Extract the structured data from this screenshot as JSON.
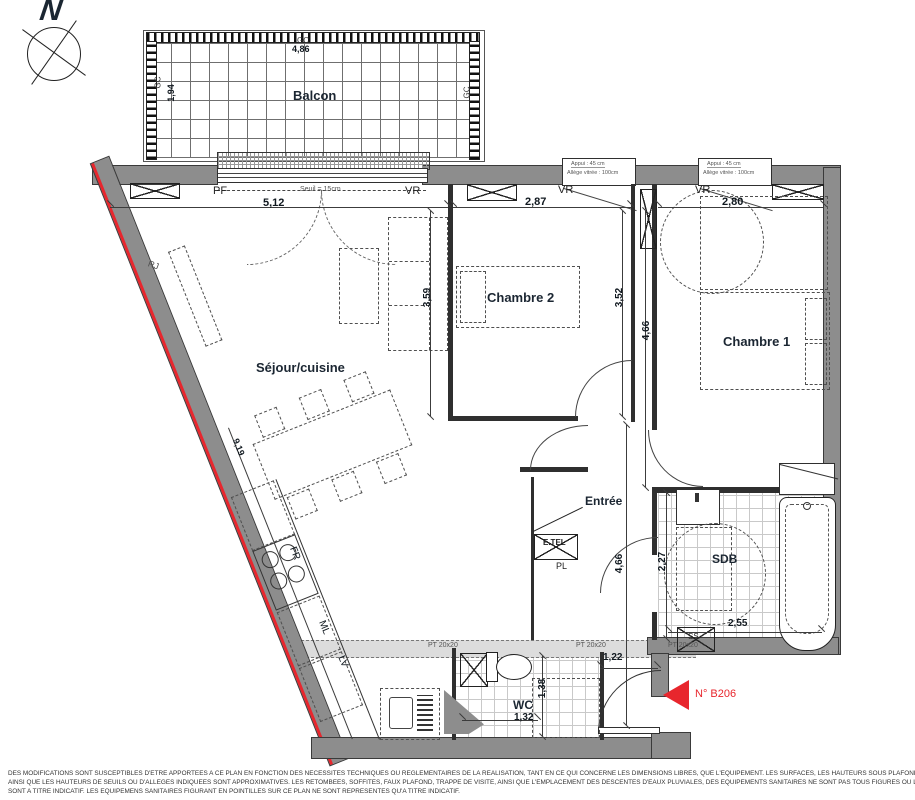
{
  "compass": {
    "letter": "N"
  },
  "balcony": {
    "name": "Balcon",
    "top_code": "GC",
    "top_dim": "4,86",
    "left_code": "GC",
    "left_dim": "1,94",
    "right_code": "GC"
  },
  "openings": {
    "bay": {
      "label": "PF",
      "sill_note": "Seuil = 15cm",
      "dim": "5,12",
      "shutter": "VR"
    },
    "window_ch2": {
      "shutter": "VR",
      "dim": "2,87",
      "note1": "Appui : 45 cm",
      "note2": "Allège vitrée : 100cm"
    },
    "window_ch1": {
      "shutter": "VR",
      "dim": "2,80",
      "note1": "Appui : 45 cm",
      "note2": "Allège vitrée : 100cm"
    }
  },
  "rooms": {
    "sejour": {
      "name": "Séjour/cuisine",
      "slant_dim": "9,19",
      "radiator_tag": "RJ"
    },
    "chambre2": {
      "name": "Chambre 2",
      "dim_left": "3,59",
      "dim_right": "3,52"
    },
    "chambre1": {
      "name": "Chambre 1",
      "dim_left": "4,66"
    },
    "entree": {
      "name": "Entrée",
      "dim_height": "4,66",
      "door_dim": "1,22",
      "closet_label": "PL",
      "panel_label": "E.TEL"
    },
    "sdb": {
      "name": "SDB",
      "dim_width": "2,55",
      "dim_depth": "2,27",
      "duct_label": "SS"
    },
    "wc": {
      "name": "WC",
      "dim_width": "1,32",
      "dim_depth": "1,38"
    }
  },
  "kitchen": {
    "fridge": "FR",
    "washing_machine": "ML",
    "dishwasher": "LV"
  },
  "beams": {
    "left": "PT 20x20",
    "mid": "PT 20x20",
    "right": "PT 20x20"
  },
  "unit": {
    "number": "N° B206"
  },
  "colors": {
    "wall": "#8d8d8d",
    "red": "#e8262d",
    "label": "#1b2632"
  },
  "disclaimer": {
    "line1": "DES MODIFICATIONS SONT SUSCEPTIBLES D'ETRE APPORTEES A CE PLAN EN FONCTION DES NECESSITES TECHNIQUES OU REGLEMENTAIRES DE LA REALISATION, TANT EN CE QUI CONCERNE LES DIMENSIONS LIBRES, QUE L'EQUIPEMENT. LES SURFACES, LES HAUTEURS SOUS PLAFOND",
    "line2": "AINSI QUE LES HAUTEURS DE SEUILS OU D'ALLEGES INDIQUEES SONT APPROXIMATIVES. LES RETOMBEES, SOFFITES, FAUX PLAFOND, TRAPPE DE VISITE, AINSI QUE L'EMPLACEMENT DES DESCENTES D'EAUX PLUVIALES, DES EQUIPEMENTS SANITAIRES NE SONT PAS TOUS FIGURES OU LE",
    "line3": "SONT A TITRE INDICATIF. LES EQUIPEMENS SANITAIRES FIGURANT EN POINTILLES SUR CE PLAN NE SONT REPRESENTES QU'A TITRE INDICATIF."
  }
}
